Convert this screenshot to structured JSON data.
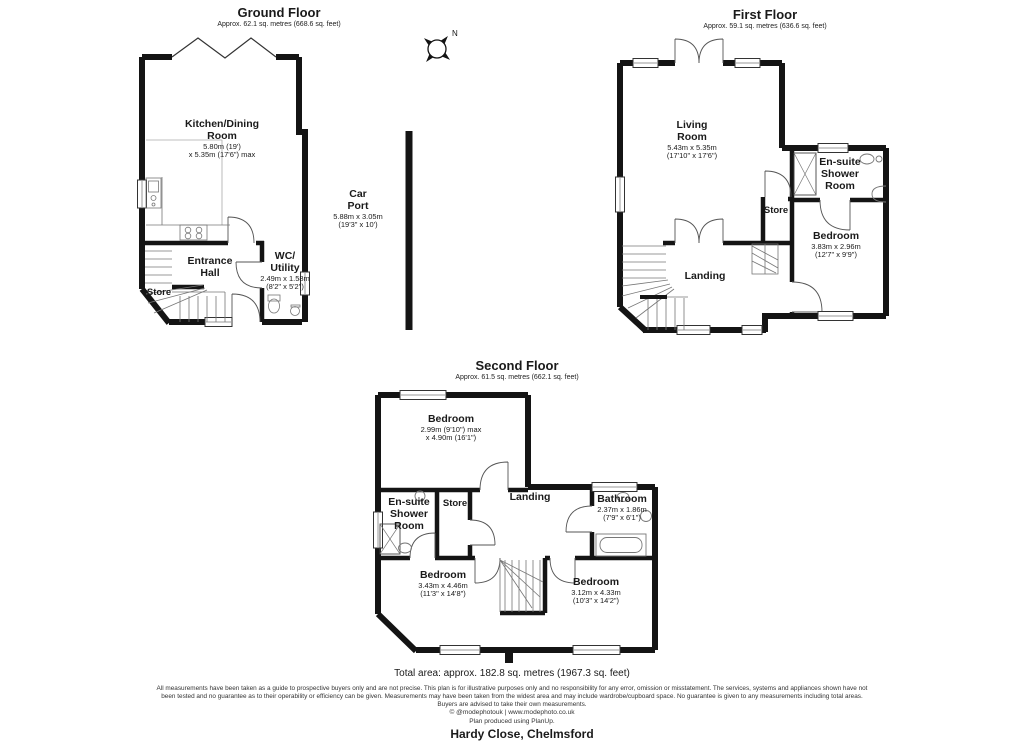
{
  "compass": {
    "label": "N"
  },
  "ground_floor": {
    "title": "Ground Floor",
    "area": "Approx. 62.1 sq. metres (668.6 sq. feet)",
    "rooms": {
      "kitchen": {
        "name1": "Kitchen/Dining",
        "name2": "Room",
        "dim1": "5.80m (19')",
        "dim2": "x 5.35m (17'6\") max"
      },
      "car_port": {
        "name1": "Car",
        "name2": "Port",
        "dim1": "5.88m x 3.05m",
        "dim2": "(19'3\" x 10')"
      },
      "entrance_hall": {
        "name1": "Entrance",
        "name2": "Hall"
      },
      "wc_utility": {
        "name1": "WC/",
        "name2": "Utility",
        "dim1": "2.49m x 1.58m",
        "dim2": "(8'2\" x 5'2\")"
      },
      "store": {
        "name1": "Store"
      }
    }
  },
  "first_floor": {
    "title": "First Floor",
    "area": "Approx. 59.1 sq. metres (636.6 sq. feet)",
    "rooms": {
      "living_room": {
        "name1": "Living",
        "name2": "Room",
        "dim1": "5.43m x 5.35m",
        "dim2": "(17'10\" x 17'6\")"
      },
      "ensuite": {
        "name1": "En-suite",
        "name2": "Shower",
        "name3": "Room"
      },
      "store": {
        "name1": "Store"
      },
      "bedroom": {
        "name1": "Bedroom",
        "dim1": "3.83m x 2.96m",
        "dim2": "(12'7\" x 9'9\")"
      },
      "landing": {
        "name1": "Landing"
      }
    }
  },
  "second_floor": {
    "title": "Second Floor",
    "area": "Approx. 61.5 sq. metres (662.1 sq. feet)",
    "rooms": {
      "bedroom_top": {
        "name1": "Bedroom",
        "dim1": "2.99m (9'10\") max",
        "dim2": "x 4.90m (16'1\")"
      },
      "ensuite": {
        "name1": "En-suite",
        "name2": "Shower",
        "name3": "Room"
      },
      "store": {
        "name1": "Store"
      },
      "landing": {
        "name1": "Landing"
      },
      "bathroom": {
        "name1": "Bathroom",
        "dim1": "2.37m x 1.86m",
        "dim2": "(7'9\" x 6'1\")"
      },
      "bedroom_left": {
        "name1": "Bedroom",
        "dim1": "3.43m x 4.46m",
        "dim2": "(11'3\" x 14'8\")"
      },
      "bedroom_right": {
        "name1": "Bedroom",
        "dim1": "3.12m x 4.33m",
        "dim2": "(10'3\" x 14'2\")"
      }
    }
  },
  "footer": {
    "total_area": "Total area: approx. 182.8 sq. metres (1967.3 sq. feet)",
    "disclaimer_line1": "All measurements have been taken as a guide to prospective buyers only and are not precise. This plan is for illustrative purposes only and no responsibility for any error, omission or misstatement. The services, systems and appliances shown have not",
    "disclaimer_line2": "been tested and no guarantee as to their operability or efficiency can be given. Measurements may have been taken from the widest area and may include wardrobe/cupboard space. No guarantee is given to any measurements including total areas.",
    "disclaimer_line3": "Buyers are advised to take their own measurements.",
    "credit": "© @modephotouk | www.modephoto.co.uk",
    "produced": "Plan produced using PlanUp.",
    "address": "Hardy Close, Chelmsford"
  }
}
